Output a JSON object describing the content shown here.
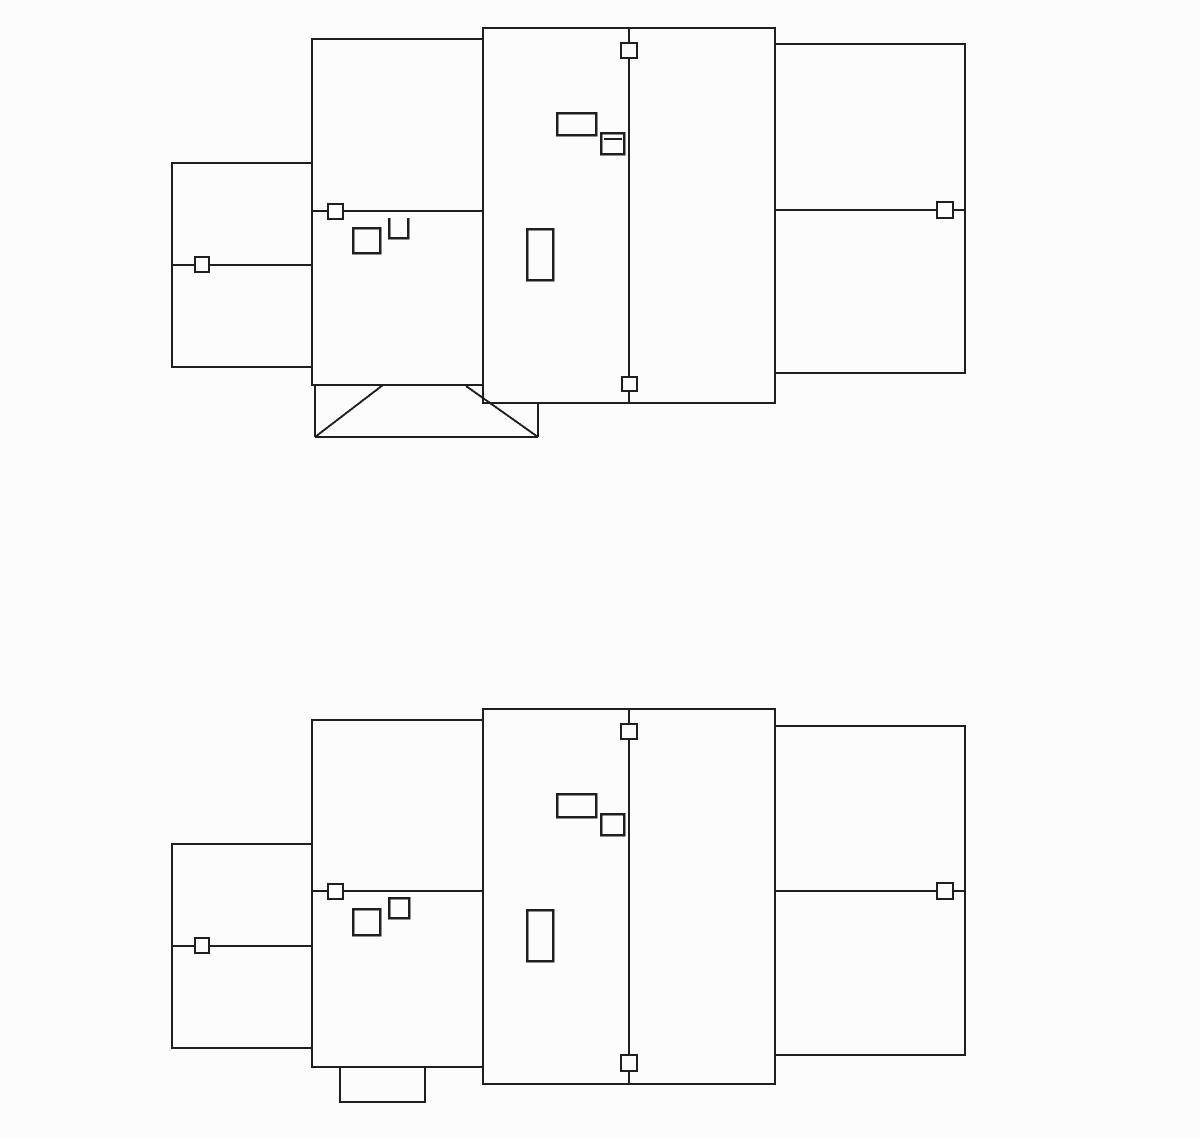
{
  "canvas": {
    "width": 1200,
    "height": 1138,
    "background": "#fcfcfc",
    "line_color": "#1f1f1f"
  },
  "diagrams": [
    {
      "id": "upper-roof-plan",
      "shapes": [
        {
          "type": "rect",
          "name": "left-wing-outline",
          "x": 172,
          "y": 163,
          "w": 140,
          "h": 204,
          "sw": 2
        },
        {
          "type": "rect",
          "name": "mid-wing-outline",
          "x": 312,
          "y": 39,
          "w": 171,
          "h": 346,
          "sw": 2
        },
        {
          "type": "rect",
          "name": "right-wing-outline",
          "x": 775,
          "y": 44,
          "w": 190,
          "h": 329,
          "sw": 2
        },
        {
          "type": "rect",
          "name": "center-block-outline",
          "x": 483,
          "y": 28,
          "w": 292,
          "h": 375,
          "sw": 2
        },
        {
          "type": "line",
          "name": "left-wing-ridge-line",
          "x1": 172,
          "y1": 265,
          "x2": 312,
          "y2": 265,
          "sw": 2
        },
        {
          "type": "line",
          "name": "mid-wing-ridge-line",
          "x1": 312,
          "y1": 211,
          "x2": 483,
          "y2": 211,
          "sw": 2
        },
        {
          "type": "line",
          "name": "right-wing-ridge-line",
          "x1": 775,
          "y1": 210,
          "x2": 965,
          "y2": 210,
          "sw": 2
        },
        {
          "type": "line",
          "name": "center-ridge-line",
          "x1": 629,
          "y1": 28,
          "x2": 629,
          "y2": 403,
          "sw": 2
        },
        {
          "type": "line",
          "name": "porch-left-wall",
          "x1": 315,
          "y1": 385,
          "x2": 315,
          "y2": 437,
          "sw": 2
        },
        {
          "type": "line",
          "name": "porch-bottom-edge",
          "x1": 315,
          "y1": 437,
          "x2": 538,
          "y2": 437,
          "sw": 2
        },
        {
          "type": "line",
          "name": "porch-right-wall",
          "x1": 538,
          "y1": 404,
          "x2": 538,
          "y2": 437,
          "sw": 2
        },
        {
          "type": "line",
          "name": "porch-hip-left",
          "x1": 315,
          "y1": 437,
          "x2": 383,
          "y2": 385,
          "sw": 2
        },
        {
          "type": "line",
          "name": "porch-hip-right",
          "x1": 466,
          "y1": 386,
          "x2": 538,
          "y2": 437,
          "sw": 2
        },
        {
          "type": "rect",
          "name": "chimney-rect",
          "x": 557,
          "y": 113,
          "w": 39,
          "h": 22,
          "sw": 2.5
        },
        {
          "type": "rect",
          "name": "skylight-rect",
          "x": 601,
          "y": 133,
          "w": 23,
          "h": 21,
          "sw": 2.5
        },
        {
          "type": "line",
          "name": "skylight-inner-line",
          "x1": 604,
          "y1": 139,
          "x2": 622,
          "y2": 139,
          "sw": 2
        },
        {
          "type": "rect",
          "name": "vent-tall-rect",
          "x": 527,
          "y": 229,
          "w": 26,
          "h": 51,
          "sw": 2.5
        },
        {
          "type": "rect",
          "name": "dormer-rect",
          "x": 353,
          "y": 228,
          "w": 27,
          "h": 25,
          "sw": 2.5
        },
        {
          "type": "path",
          "name": "open-top-box",
          "d": "M389,218 L389,238 L408,238 L408,218",
          "sw": 2.5
        },
        {
          "type": "marker",
          "name": "ridge-box-marker-left-wing",
          "x": 195,
          "y": 257,
          "w": 14,
          "h": 15,
          "sw": 2
        },
        {
          "type": "marker",
          "name": "ridge-box-marker-mid-wing",
          "x": 328,
          "y": 204,
          "w": 15,
          "h": 15,
          "sw": 2
        },
        {
          "type": "marker",
          "name": "ridge-box-marker-right-wing",
          "x": 937,
          "y": 202,
          "w": 16,
          "h": 16,
          "sw": 2
        },
        {
          "type": "marker",
          "name": "ridge-box-marker-center-top",
          "x": 621,
          "y": 43,
          "w": 16,
          "h": 15,
          "sw": 2
        },
        {
          "type": "marker",
          "name": "ridge-box-marker-center-bottom",
          "x": 622,
          "y": 377,
          "w": 15,
          "h": 14,
          "sw": 2
        }
      ]
    },
    {
      "id": "lower-roof-plan",
      "shapes": [
        {
          "type": "rect",
          "name": "left-wing-outline",
          "x": 172,
          "y": 844,
          "w": 140,
          "h": 204,
          "sw": 2
        },
        {
          "type": "rect",
          "name": "mid-wing-outline",
          "x": 312,
          "y": 720,
          "w": 171,
          "h": 347,
          "sw": 2
        },
        {
          "type": "rect",
          "name": "right-wing-outline",
          "x": 775,
          "y": 726,
          "w": 190,
          "h": 329,
          "sw": 2
        },
        {
          "type": "rect",
          "name": "center-block-outline",
          "x": 483,
          "y": 709,
          "w": 292,
          "h": 375,
          "sw": 2
        },
        {
          "type": "rect",
          "name": "bump-out-outline",
          "x": 340,
          "y": 1067,
          "w": 85,
          "h": 35,
          "sw": 2
        },
        {
          "type": "line",
          "name": "left-wing-ridge-line",
          "x1": 172,
          "y1": 946,
          "x2": 312,
          "y2": 946,
          "sw": 2
        },
        {
          "type": "line",
          "name": "mid-wing-ridge-line",
          "x1": 312,
          "y1": 891,
          "x2": 483,
          "y2": 891,
          "sw": 2
        },
        {
          "type": "line",
          "name": "right-wing-ridge-line",
          "x1": 775,
          "y1": 891,
          "x2": 965,
          "y2": 891,
          "sw": 2
        },
        {
          "type": "line",
          "name": "center-ridge-line",
          "x1": 629,
          "y1": 709,
          "x2": 629,
          "y2": 1084,
          "sw": 2
        },
        {
          "type": "rect",
          "name": "chimney-rect",
          "x": 557,
          "y": 794,
          "w": 39,
          "h": 23,
          "sw": 2.5
        },
        {
          "type": "rect",
          "name": "skylight-rect",
          "x": 601,
          "y": 814,
          "w": 23,
          "h": 21,
          "sw": 2.5
        },
        {
          "type": "rect",
          "name": "vent-tall-rect",
          "x": 527,
          "y": 910,
          "w": 26,
          "h": 51,
          "sw": 2.5
        },
        {
          "type": "rect",
          "name": "dormer-rect",
          "x": 353,
          "y": 909,
          "w": 27,
          "h": 26,
          "sw": 2.5
        },
        {
          "type": "rect",
          "name": "small-box",
          "x": 389,
          "y": 898,
          "w": 20,
          "h": 20,
          "sw": 2.5
        },
        {
          "type": "marker",
          "name": "ridge-box-marker-left-wing",
          "x": 195,
          "y": 938,
          "w": 14,
          "h": 15,
          "sw": 2
        },
        {
          "type": "marker",
          "name": "ridge-box-marker-mid-wing",
          "x": 328,
          "y": 884,
          "w": 15,
          "h": 15,
          "sw": 2
        },
        {
          "type": "marker",
          "name": "ridge-box-marker-right-wing",
          "x": 937,
          "y": 883,
          "w": 16,
          "h": 16,
          "sw": 2
        },
        {
          "type": "marker",
          "name": "ridge-box-marker-center-top",
          "x": 621,
          "y": 724,
          "w": 16,
          "h": 15,
          "sw": 2
        },
        {
          "type": "marker",
          "name": "ridge-box-marker-center-bottom",
          "x": 621,
          "y": 1055,
          "w": 16,
          "h": 16,
          "sw": 2
        }
      ]
    }
  ]
}
